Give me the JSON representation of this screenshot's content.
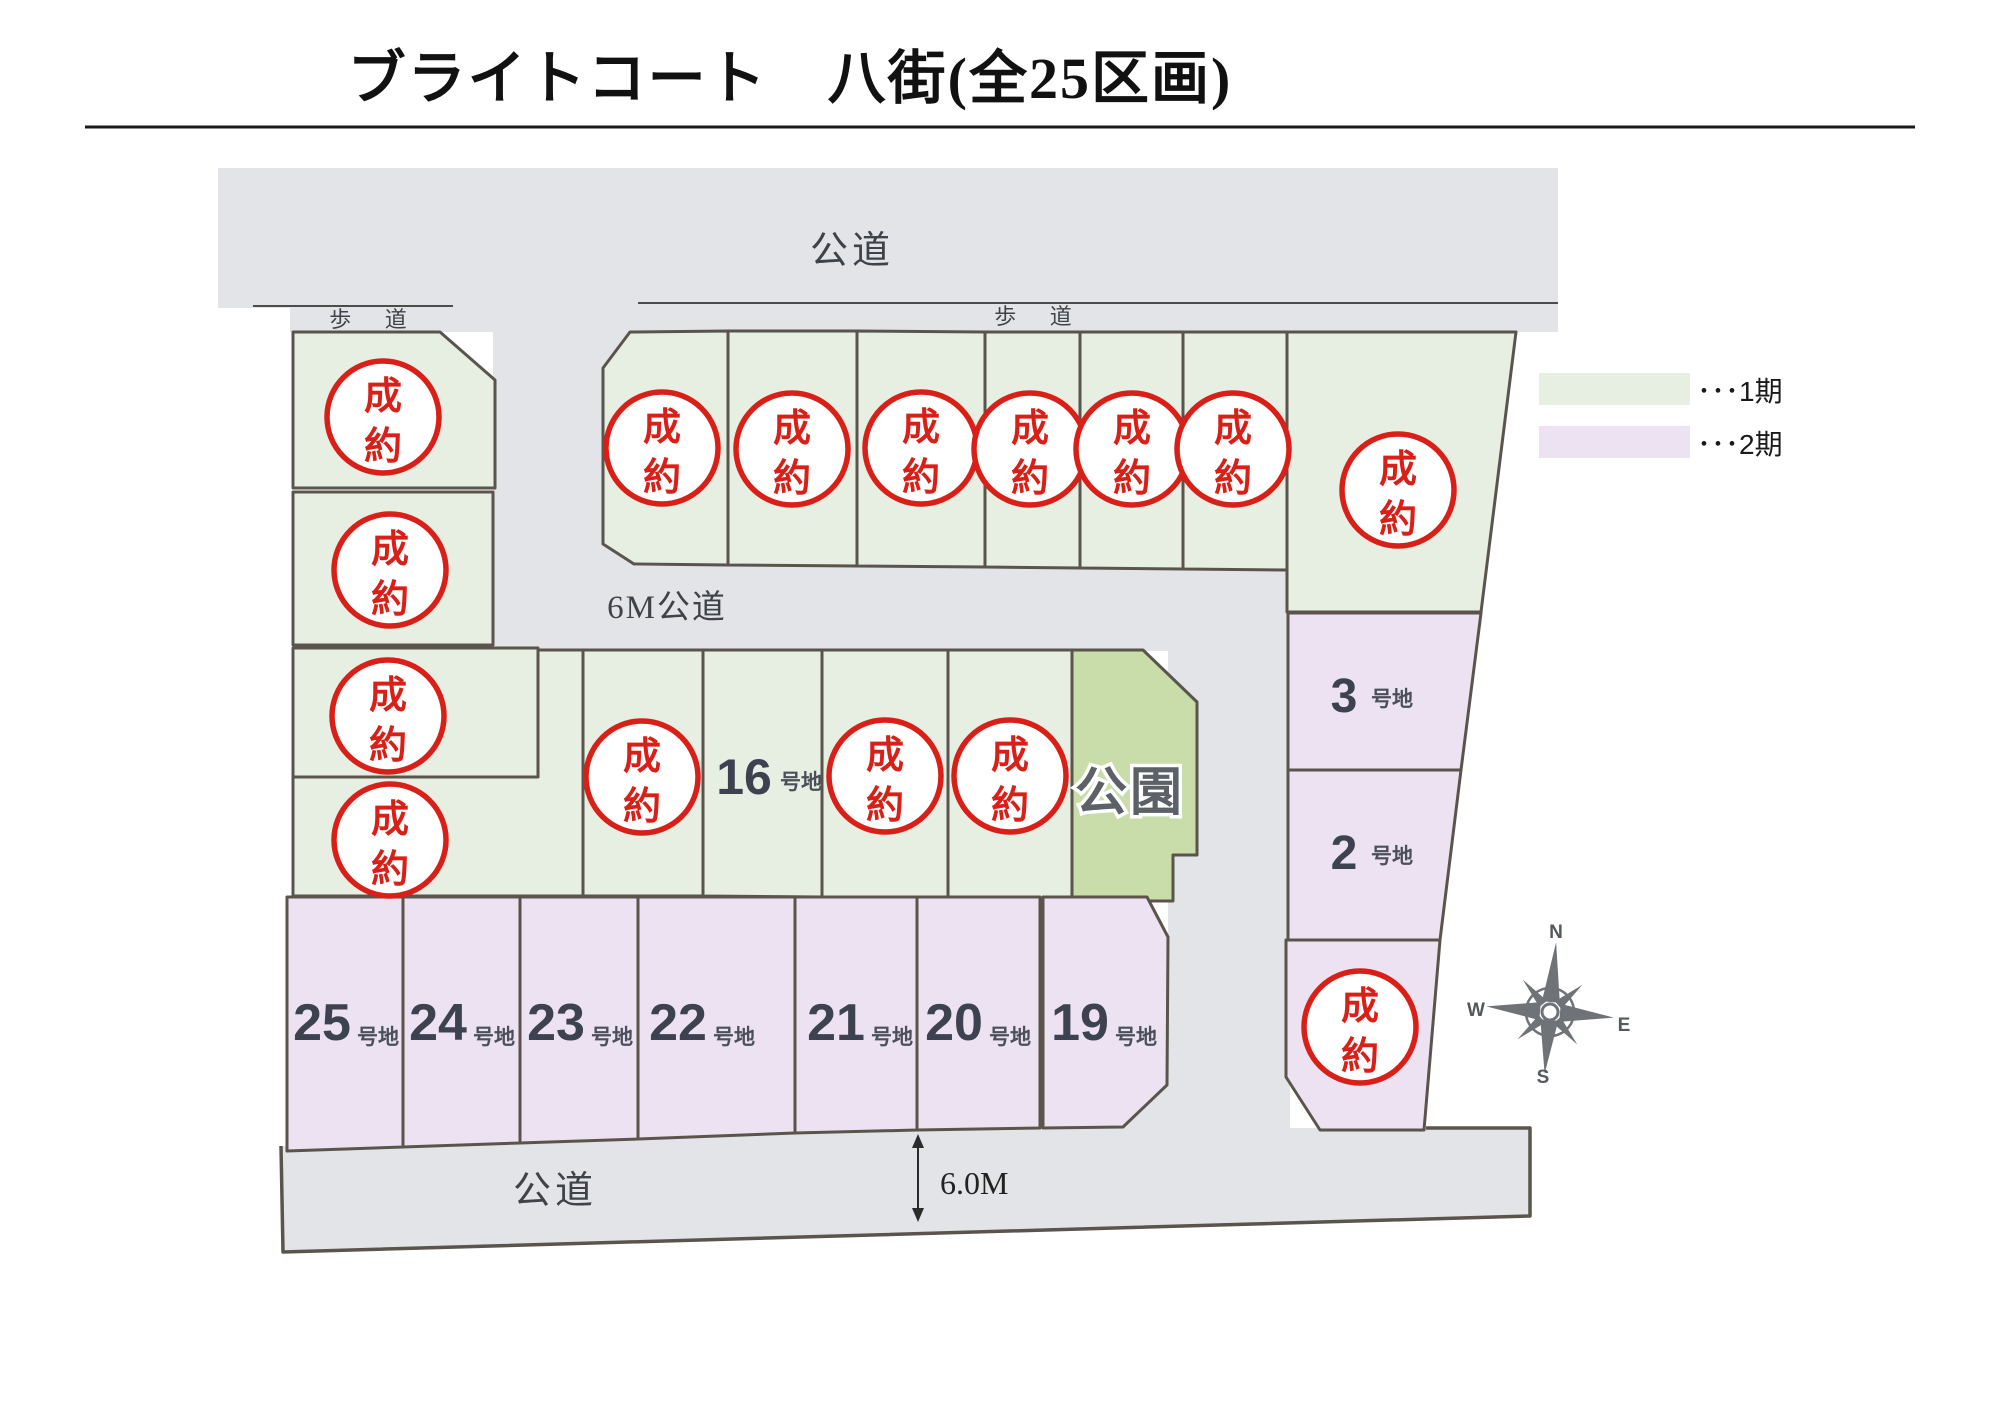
{
  "title": {
    "text": "ブライトコート　八街(全25区画)"
  },
  "sold_mark": "成約",
  "colors": {
    "phase1": "#e6efe2",
    "phase2": "#ece2f1",
    "park": "#c8ddaa",
    "road": "#e3e4e7",
    "border": "#5a544c",
    "sidewalk_line": "#4c4c4c",
    "circle_red": "#d92018",
    "number": "#3d4250",
    "suffix": "#4a4f5a",
    "road_text": "#3f4246",
    "park_text": "#5c6167",
    "compass": "#6f7378",
    "title_color": "#111111"
  },
  "legend": {
    "items": [
      {
        "phase": "phase1",
        "label": "･･･1期"
      },
      {
        "phase": "phase2",
        "label": "･･･2期"
      }
    ]
  },
  "map": {
    "roads": [
      {
        "name": "road-public-top",
        "points": "218,168 1558,168 1558,332 290,332 290,308 218,308"
      },
      {
        "name": "road-west-vertical",
        "points": "493,331 635,331 635,651 493,651"
      },
      {
        "name": "road-6m-horizontal",
        "points": "493,566 1290,566 1290,651 493,651"
      },
      {
        "name": "road-east-vertical",
        "points": "1168,566 1290,566 1290,1135 1168,1135"
      },
      {
        "name": "road-public-bottom",
        "points": "281,1146 1123,1126 1167,1085 1286,1085 1286,1128 1530,1128 1530,1216 283,1252"
      }
    ],
    "boundary_path": "M281,1146 L283,1252 L1530,1216 L1530,1128 L1426,1128",
    "sidewalk_lines": [
      {
        "x1": 253,
        "y1": 306,
        "x2": 453,
        "y2": 306
      },
      {
        "x1": 638,
        "y1": 303,
        "x2": 1558,
        "y2": 303
      }
    ],
    "lots": [
      {
        "name": "lot-west-1",
        "phase": "phase1",
        "points": "293,332 440,332 495,380 495,488 293,488",
        "sold": {
          "cx": 383,
          "cy": 417
        }
      },
      {
        "name": "lot-west-2",
        "phase": "phase1",
        "points": "293,492 493,492 493,645 293,645",
        "sold": {
          "cx": 390,
          "cy": 570
        }
      },
      {
        "name": "lot-west-3",
        "phase": "phase1",
        "points": "293,648 538,648 538,777 293,777",
        "sold": {
          "cx": 388,
          "cy": 716
        }
      },
      {
        "name": "lot-west-4",
        "phase": "phase1",
        "points": "293,777 538,777 538,650 583,650 583,896 293,896",
        "sold": {
          "cx": 390,
          "cy": 840
        }
      },
      {
        "name": "lot-top-1",
        "phase": "phase1",
        "points": "630,332 728,331 728,565 634,564 603,544 603,368",
        "sold": {
          "cx": 662,
          "cy": 448
        }
      },
      {
        "name": "lot-top-2",
        "phase": "phase1",
        "points": "728,331 857,331 857,566 728,565",
        "sold": {
          "cx": 792,
          "cy": 449
        }
      },
      {
        "name": "lot-top-3",
        "phase": "phase1",
        "points": "857,331 985,332 985,567 857,566",
        "sold": {
          "cx": 921,
          "cy": 448
        }
      },
      {
        "name": "lot-top-4",
        "phase": "phase1",
        "points": "985,332 1080,332 1080,568 985,567",
        "sold": {
          "cx": 1030,
          "cy": 449
        }
      },
      {
        "name": "lot-top-5",
        "phase": "phase1",
        "points": "1080,332 1183,332 1183,569 1080,568",
        "sold": {
          "cx": 1132,
          "cy": 449
        }
      },
      {
        "name": "lot-top-6",
        "phase": "phase1",
        "points": "1183,332 1287,332 1287,570 1183,569",
        "sold": {
          "cx": 1233,
          "cy": 449
        }
      },
      {
        "name": "lot-top-7",
        "phase": "phase1",
        "points": "1287,332 1516,332 1481,612 1287,612",
        "sold": {
          "cx": 1398,
          "cy": 490
        }
      },
      {
        "name": "lot-mid-1",
        "phase": "phase1",
        "points": "583,650 703,650 703,896 583,896",
        "sold": {
          "cx": 642,
          "cy": 777
        }
      },
      {
        "name": "lot-16",
        "phase": "phase1",
        "points": "703,650 822,650 822,897 703,896",
        "num": {
          "value": "16",
          "x": 744,
          "y": 794,
          "size": 50,
          "suffix": "号地",
          "sx": 801,
          "sy": 789
        }
      },
      {
        "name": "lot-mid-3",
        "phase": "phase1",
        "points": "822,650 948,650 948,898 822,897",
        "sold": {
          "cx": 885,
          "cy": 776
        }
      },
      {
        "name": "lot-mid-4",
        "phase": "phase1",
        "points": "948,650 1072,650 1072,899 948,898",
        "sold": {
          "cx": 1010,
          "cy": 776
        }
      },
      {
        "name": "lot-park",
        "phase": "park",
        "points": "1072,650 1143,650 1197,702 1197,855 1173,855 1173,901 1072,901",
        "label": {
          "text": "公園",
          "x": 1130,
          "y": 810,
          "size": 52
        }
      },
      {
        "name": "lot-3",
        "phase": "phase2",
        "points": "1288,613 1481,613 1461,770 1288,770",
        "num": {
          "value": "3",
          "x": 1344,
          "y": 712,
          "size": 48,
          "suffix": "号地",
          "sx": 1392,
          "sy": 706
        }
      },
      {
        "name": "lot-2",
        "phase": "phase2",
        "points": "1288,770 1461,770 1440,940 1288,940",
        "num": {
          "value": "2",
          "x": 1344,
          "y": 869,
          "size": 48,
          "suffix": "号地",
          "sx": 1392,
          "sy": 863
        }
      },
      {
        "name": "lot-east-sold",
        "phase": "phase2",
        "points": "1286,940 1440,940 1424,1130 1320,1130 1286,1077",
        "sold": {
          "cx": 1360,
          "cy": 1027
        }
      },
      {
        "name": "lot-25",
        "phase": "phase2",
        "points": "287,897 403,897 403,1147 287,1151",
        "num": {
          "value": "25",
          "x": 322,
          "y": 1040,
          "size": 52,
          "suffix": "号地",
          "sx": 378,
          "sy": 1044
        }
      },
      {
        "name": "lot-24",
        "phase": "phase2",
        "points": "403,897 520,897 520,1143 403,1147",
        "num": {
          "value": "24",
          "x": 438,
          "y": 1040,
          "size": 52,
          "suffix": "号地",
          "sx": 494,
          "sy": 1044
        }
      },
      {
        "name": "lot-23",
        "phase": "phase2",
        "points": "520,897 638,897 638,1139 520,1143",
        "num": {
          "value": "23",
          "x": 556,
          "y": 1040,
          "size": 52,
          "suffix": "号地",
          "sx": 612,
          "sy": 1044
        }
      },
      {
        "name": "lot-22",
        "phase": "phase2",
        "points": "638,897 795,897 795,1133 638,1139",
        "num": {
          "value": "22",
          "x": 678,
          "y": 1040,
          "size": 52,
          "suffix": "号地",
          "sx": 734,
          "sy": 1044
        }
      },
      {
        "name": "lot-21",
        "phase": "phase2",
        "points": "795,897 917,897 917,1130 795,1133",
        "num": {
          "value": "21",
          "x": 836,
          "y": 1040,
          "size": 52,
          "suffix": "号地",
          "sx": 892,
          "sy": 1044
        }
      },
      {
        "name": "lot-20",
        "phase": "phase2",
        "points": "917,897 1040,897 1040,1128 917,1130",
        "num": {
          "value": "20",
          "x": 954,
          "y": 1040,
          "size": 52,
          "suffix": "号地",
          "sx": 1010,
          "sy": 1044
        }
      },
      {
        "name": "lot-19",
        "phase": "phase2",
        "points": "1043,897 1147,897 1168,937 1167,1085 1123,1127 1043,1128",
        "num": {
          "value": "19",
          "x": 1080,
          "y": 1040,
          "size": 52,
          "suffix": "号地",
          "sx": 1136,
          "sy": 1044
        }
      }
    ],
    "road_labels": [
      {
        "name": "label-road-top",
        "text": "公道",
        "x": 852,
        "y": 263,
        "size": 38,
        "spacing": 4
      },
      {
        "name": "label-sidewalk-left",
        "text": "歩 道",
        "x": 375,
        "y": 327,
        "size": 22,
        "spacing": 14
      },
      {
        "name": "label-sidewalk-right",
        "text": "歩 道",
        "x": 1040,
        "y": 324,
        "size": 22,
        "spacing": 14
      },
      {
        "name": "label-road-6m",
        "text": "6M公道",
        "x": 667,
        "y": 618,
        "size": 33,
        "spacing": 2
      },
      {
        "name": "label-road-bottom",
        "text": "公道",
        "x": 555,
        "y": 1203,
        "size": 38,
        "spacing": 4
      }
    ],
    "dimension": {
      "label": "6.0M",
      "x": 918,
      "y1": 1134,
      "y2": 1222,
      "tx": 940,
      "ty": 1194,
      "size": 32
    },
    "compass": {
      "cx": 1550,
      "cy": 1012,
      "rotation": 5,
      "shapes": [
        {
          "points": "0,-70 9,-10 -9,-10"
        },
        {
          "points": "0,62 9,8 -9,8"
        },
        {
          "points": "-64,0 -10,-9 -10,9"
        },
        {
          "points": "64,0 10,-9 10,9"
        },
        {
          "points": "30,-30 11,-4 4,-11"
        },
        {
          "points": "30,30 4,11 11,4"
        },
        {
          "points": "-30,30 -11,4 -4,11"
        },
        {
          "points": "-30,-30 -4,-11 -11,-4"
        }
      ],
      "ring_r": 24,
      "hub_r": 8,
      "labels": [
        {
          "t": "N",
          "x": 1556,
          "y": 938
        },
        {
          "t": "E",
          "x": 1624,
          "y": 1031
        },
        {
          "t": "S",
          "x": 1543,
          "y": 1083
        },
        {
          "t": "W",
          "x": 1476,
          "y": 1016
        }
      ]
    }
  },
  "underline": {
    "x1": 85,
    "y": 127,
    "x2": 1915
  },
  "legend_geom": {
    "x": 1539,
    "w": 151,
    "h": 32,
    "y1": 373,
    "y2": 426,
    "tx": 1697,
    "ty1": 401,
    "ty2": 454,
    "size": 28
  }
}
